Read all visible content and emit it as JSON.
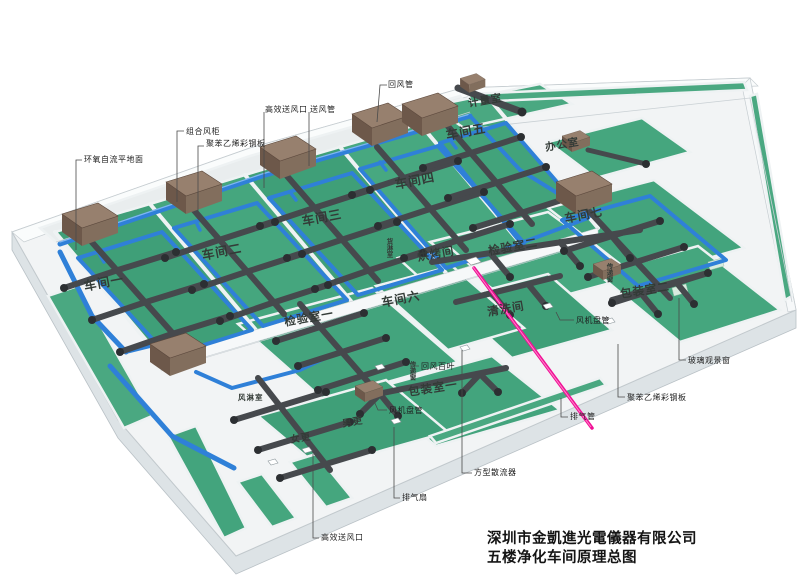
{
  "title_block": {
    "line1": "深圳市金凱進光電儀器有限公司",
    "line2": "五楼净化车间原理总图"
  },
  "room_labels": [
    {
      "text": "车间一",
      "x": 82,
      "y": 276,
      "size": 12.5,
      "rot": -11,
      "vertical": false
    },
    {
      "text": "车间二",
      "x": 200,
      "y": 245,
      "size": 12.5,
      "rot": -11,
      "vertical": false
    },
    {
      "text": "车间三",
      "x": 300,
      "y": 211,
      "size": 12.5,
      "rot": -11,
      "vertical": false
    },
    {
      "text": "车间四",
      "x": 393,
      "y": 174,
      "size": 12.5,
      "rot": -11,
      "vertical": false
    },
    {
      "text": "车间五",
      "x": 444,
      "y": 125,
      "size": 12.5,
      "rot": -11,
      "vertical": false
    },
    {
      "text": "车间六",
      "x": 380,
      "y": 294,
      "size": 12,
      "rot": -11,
      "vertical": false
    },
    {
      "text": "车间七",
      "x": 563,
      "y": 210,
      "size": 12,
      "rot": -11,
      "vertical": false
    },
    {
      "text": "检验室一",
      "x": 283,
      "y": 314,
      "size": 11.5,
      "rot": -10,
      "vertical": false
    },
    {
      "text": "检验室二",
      "x": 487,
      "y": 243,
      "size": 11.5,
      "rot": -10,
      "vertical": false
    },
    {
      "text": "烘烤间",
      "x": 416,
      "y": 249,
      "size": 11.5,
      "rot": -10,
      "vertical": false
    },
    {
      "text": "清洗间",
      "x": 486,
      "y": 304,
      "size": 11.5,
      "rot": -10,
      "vertical": false
    },
    {
      "text": "包装室一",
      "x": 407,
      "y": 384,
      "size": 11.5,
      "rot": -9,
      "vertical": false
    },
    {
      "text": "包装室二",
      "x": 619,
      "y": 286,
      "size": 11.5,
      "rot": -9,
      "vertical": false
    },
    {
      "text": "办公室",
      "x": 544,
      "y": 140,
      "size": 10.5,
      "rot": -10,
      "vertical": false
    },
    {
      "text": "计量室",
      "x": 467,
      "y": 96,
      "size": 10.5,
      "rot": -10,
      "vertical": false
    },
    {
      "text": "男更",
      "x": 341,
      "y": 416,
      "size": 9.5,
      "rot": -10,
      "vertical": false
    },
    {
      "text": "女更",
      "x": 289,
      "y": 432,
      "size": 9.5,
      "rot": -10,
      "vertical": false
    },
    {
      "text": "风淋室",
      "x": 238,
      "y": 392,
      "size": 7.5,
      "rot": 0,
      "vertical": false
    },
    {
      "text": "货淋室",
      "x": 383,
      "y": 238,
      "size": 6.5,
      "rot": 0,
      "vertical": true
    },
    {
      "text": "传递窗",
      "x": 406,
      "y": 361,
      "size": 6.5,
      "rot": 0,
      "vertical": true
    },
    {
      "text": "传递窗",
      "x": 603,
      "y": 263,
      "size": 6.5,
      "rot": 0,
      "vertical": true
    }
  ],
  "callouts": [
    {
      "text": "回风管",
      "x": 388,
      "y": 79,
      "leader": [
        [
          387,
          85
        ],
        [
          380,
          85
        ],
        [
          377,
          122
        ]
      ]
    },
    {
      "text": "高效送风口",
      "x": 265,
      "y": 104,
      "leader": [
        [
          264,
          112
        ],
        [
          264,
          188
        ]
      ]
    },
    {
      "text": "送风管",
      "x": 310,
      "y": 104,
      "leader": [
        [
          309,
          112
        ],
        [
          309,
          166
        ]
      ]
    },
    {
      "text": "组合风柜",
      "x": 186,
      "y": 126,
      "leader": [
        [
          184,
          131
        ],
        [
          177,
          131
        ],
        [
          177,
          202
        ]
      ]
    },
    {
      "text": "聚苯乙烯彩钢板",
      "x": 206,
      "y": 138,
      "leader": [
        [
          204,
          146
        ],
        [
          198,
          146
        ],
        [
          198,
          212
        ]
      ]
    },
    {
      "text": "环氧自流平地面",
      "x": 84,
      "y": 154,
      "leader": [
        [
          82,
          160
        ],
        [
          76,
          160
        ],
        [
          76,
          250
        ]
      ]
    },
    {
      "text": "风机盘管",
      "x": 576,
      "y": 315,
      "leader": [
        [
          574,
          320
        ],
        [
          560,
          320
        ],
        [
          556,
          312
        ]
      ]
    },
    {
      "text": "玻璃观景窗",
      "x": 688,
      "y": 355,
      "leader": [
        [
          686,
          360
        ],
        [
          679,
          360
        ],
        [
          679,
          298
        ]
      ]
    },
    {
      "text": "聚苯乙烯彩钢板",
      "x": 627,
      "y": 392,
      "leader": [
        [
          625,
          397
        ],
        [
          618,
          397
        ],
        [
          618,
          344
        ]
      ]
    },
    {
      "text": "排气管",
      "x": 570,
      "y": 411,
      "leader": [
        [
          568,
          417
        ],
        [
          561,
          417
        ],
        [
          561,
          398
        ]
      ]
    },
    {
      "text": "方型散流器",
      "x": 474,
      "y": 467,
      "leader": [
        [
          472,
          473
        ],
        [
          462,
          473
        ],
        [
          462,
          350
        ]
      ]
    },
    {
      "text": "排气扇",
      "x": 402,
      "y": 492,
      "leader": [
        [
          400,
          498
        ],
        [
          394,
          498
        ],
        [
          394,
          427
        ]
      ]
    },
    {
      "text": "高效送风口",
      "x": 321,
      "y": 532,
      "leader": [
        [
          319,
          538
        ],
        [
          313,
          538
        ],
        [
          313,
          454
        ]
      ]
    },
    {
      "text": "风机盘管",
      "x": 389,
      "y": 405,
      "leader": [
        [
          387,
          410
        ],
        [
          378,
          410
        ],
        [
          374,
          401
        ]
      ]
    },
    {
      "text": "回风百叶",
      "x": 421,
      "y": 361,
      "leader": [
        [
          419,
          366
        ],
        [
          412,
          366
        ],
        [
          412,
          376
        ]
      ]
    }
  ],
  "colors": {
    "floor_green": "#43a47d",
    "supply_duct_blue": "#2f80d8",
    "exhaust_duct_gray": "#46494d",
    "ahu_brown": "#8a7464",
    "exhaust_pink": "#f00f96",
    "wall_light": "#f2f4f5"
  }
}
